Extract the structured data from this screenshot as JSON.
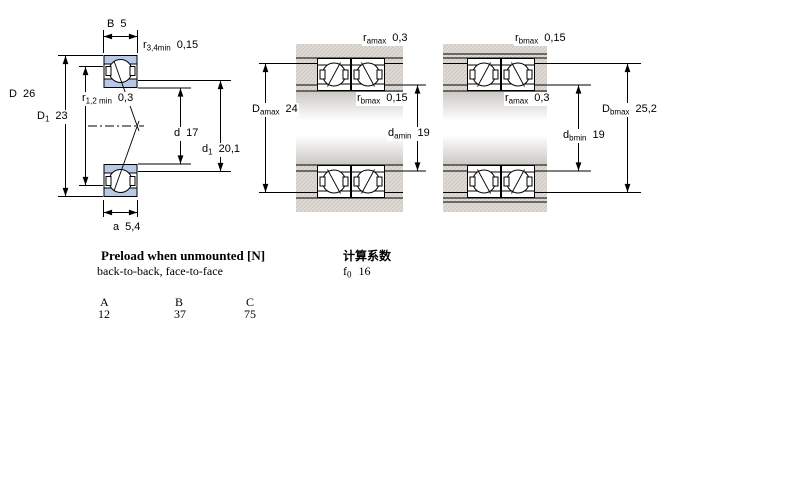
{
  "colors": {
    "line": "#000000",
    "bearing_fill": "#b7c9e6",
    "band_base": "#ded9d4",
    "band_hatch": "#cfc8c2"
  },
  "diagrams": {
    "left": {
      "labels": {
        "B": {
          "base": "B",
          "sub": "",
          "val": "5"
        },
        "r34": {
          "base": "r",
          "sub": "3,4min",
          "val": "0,15"
        },
        "D": {
          "base": "D",
          "sub": "",
          "val": "26"
        },
        "D1": {
          "base": "D",
          "sub": "1",
          "val": "23"
        },
        "r12": {
          "base": "r",
          "sub": "1,2 min",
          "val": "0,3"
        },
        "d": {
          "base": "d",
          "sub": "",
          "val": "17"
        },
        "d1": {
          "base": "d",
          "sub": "1",
          "val": "20,1"
        },
        "a": {
          "base": "a",
          "sub": "",
          "val": "5,4"
        }
      }
    },
    "middle": {
      "labels": {
        "ramax": {
          "base": "r",
          "sub": "amax",
          "val": "0,3"
        },
        "Damax": {
          "base": "D",
          "sub": "amax",
          "val": "24"
        },
        "rbmax": {
          "base": "r",
          "sub": "bmax",
          "val": "0,15"
        },
        "damin": {
          "base": "d",
          "sub": "amin",
          "val": "19"
        }
      }
    },
    "right": {
      "labels": {
        "rbmax": {
          "base": "r",
          "sub": "bmax",
          "val": "0,15"
        },
        "ramax": {
          "base": "r",
          "sub": "amax",
          "val": "0,3"
        },
        "Dbmax": {
          "base": "D",
          "sub": "bmax",
          "val": "25,2"
        },
        "dbmin": {
          "base": "d",
          "sub": "bmin",
          "val": "19"
        }
      }
    }
  },
  "preload": {
    "title": "Preload when unmounted [N]",
    "subtitle": "back-to-back, face-to-face",
    "columns": [
      "A",
      "B",
      "C"
    ],
    "values": [
      "12",
      "37",
      "75"
    ]
  },
  "calc": {
    "title": "计算系数",
    "f0": {
      "base": "f",
      "sub": "0",
      "val": "16"
    }
  }
}
